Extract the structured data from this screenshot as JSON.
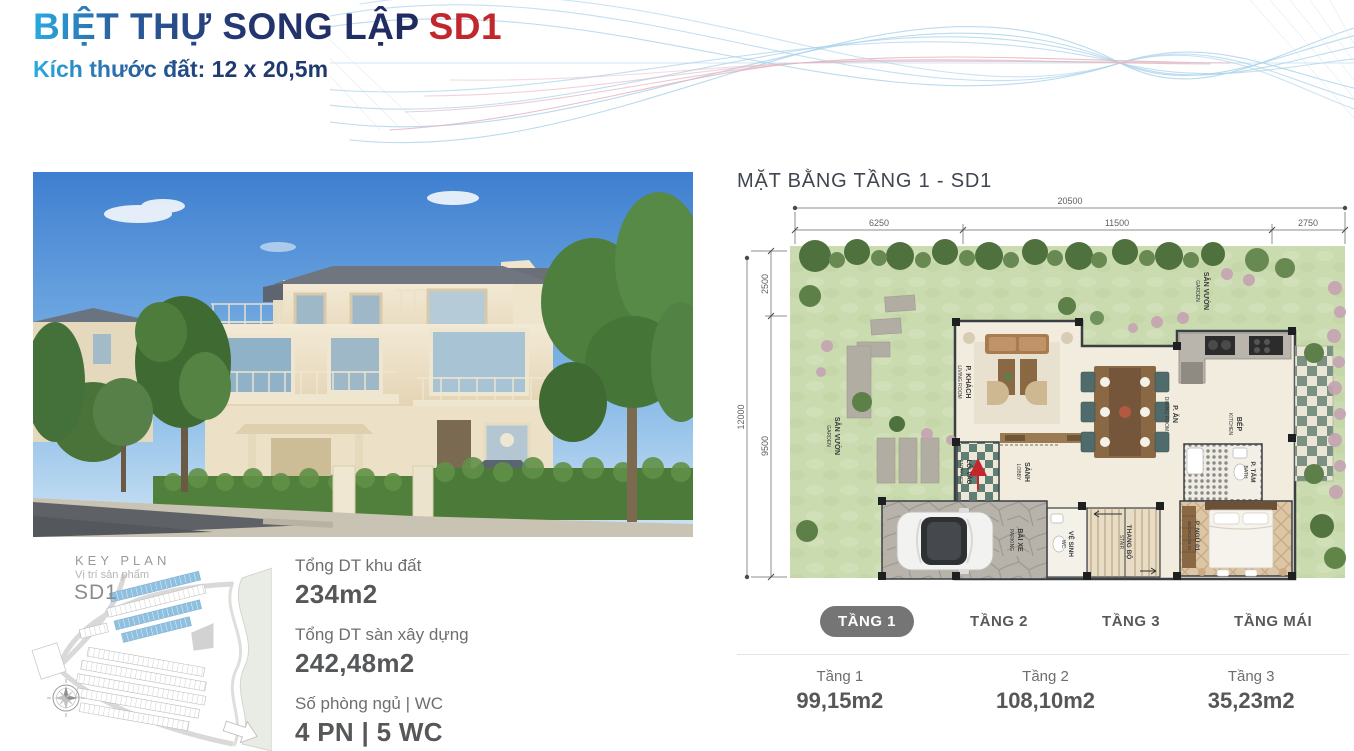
{
  "header": {
    "title": "BIỆT THỰ SONG LẬP",
    "title_code": "SD1",
    "subtitle": "Kích thước đất: 12 x 20,5m"
  },
  "key_plan": {
    "title": "KEY PLAN",
    "subtitle": "Vị trí sản phẩm",
    "code": "SD1"
  },
  "specs": [
    {
      "label": "Tổng DT khu đất",
      "value": "234m2"
    },
    {
      "label": "Tổng DT sàn xây dựng",
      "value": "242,48m2"
    },
    {
      "label": "Số phòng ngủ | WC",
      "value": "4 PN | 5 WC"
    }
  ],
  "floor_plan": {
    "title": "MẶT BẰNG TẦNG 1 - SD1",
    "dims": {
      "top_total": "20500",
      "top_segments": [
        "6250",
        "11500",
        "2750"
      ],
      "left_total": "12000",
      "left_segments": [
        "2500",
        "9500"
      ]
    },
    "rooms": [
      {
        "vi": "SÂN VƯỜN",
        "en": "GARDEN"
      },
      {
        "vi": "P. KHÁCH",
        "en": "LIVING ROOM"
      },
      {
        "vi": "P. ĂN",
        "en": "DINING ROOM"
      },
      {
        "vi": "BẾP",
        "en": "KITCHEN"
      },
      {
        "vi": "SẢNH",
        "en": "LOBBY"
      },
      {
        "vi": "LỐI VÀO",
        "en": "ENTRANCE"
      },
      {
        "vi": "BÃI XE",
        "en": "PARKING"
      },
      {
        "vi": "VỆ SINH",
        "en": "WC"
      },
      {
        "vi": "THANG BỘ",
        "en": "STAIR"
      },
      {
        "vi": "P. TẮM",
        "en": "BATH"
      },
      {
        "vi": "P. NGỦ 01",
        "en": "BEDROOM 01"
      }
    ]
  },
  "tabs": [
    {
      "label": "TẦNG 1",
      "active": true
    },
    {
      "label": "TẦNG 2",
      "active": false
    },
    {
      "label": "TẦNG 3",
      "active": false
    },
    {
      "label": "TẦNG MÁI",
      "active": false
    }
  ],
  "floor_areas": [
    {
      "label": "Tầng 1",
      "value": "99,15m2"
    },
    {
      "label": "Tầng 2",
      "value": "108,10m2"
    },
    {
      "label": "Tầng 3",
      "value": "35,23m2"
    }
  ],
  "colors": {
    "accent_blue": "#29abe2",
    "navy": "#1f2a5e",
    "crimson": "#c1272d",
    "gray_text": "#6d6e71",
    "tab_active_bg": "#757575"
  }
}
